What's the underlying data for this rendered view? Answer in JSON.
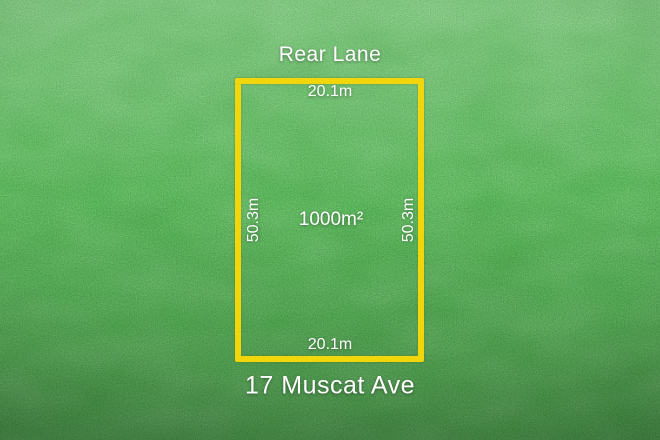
{
  "lot": {
    "street_top": "Rear Lane",
    "address": "17 Muscat Ave",
    "area": "1000m²",
    "frontage_top": "20.1m",
    "frontage_bottom": "20.1m",
    "depth_left": "50.3m",
    "depth_right": "50.3m"
  },
  "colors": {
    "boundary_yellow": "#F0D60B",
    "label_white": "#FFFFFF",
    "grass_green": "#2E7D33"
  }
}
